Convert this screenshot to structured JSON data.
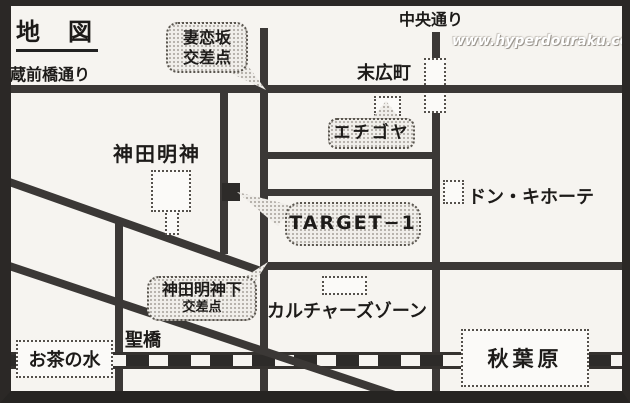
{
  "map": {
    "title": "地　図",
    "watermark": "www.hyperdouraku.com",
    "colors": {
      "paper": "#f6f4f0",
      "road": "#3b3836",
      "frame": "#2b2826",
      "rail_dark": "#2d2b29",
      "bubble_fill": "#f0eeea",
      "target_building": "#2d2b29"
    },
    "roads": {
      "kuramaebashi_dori": "蔵前橋通り",
      "chuo_dori": "中央通り"
    },
    "intersections": {
      "tsumakoizaka": {
        "line1": "妻恋坂",
        "line2": "交差点"
      },
      "kanda_myojin_shita": {
        "line1": "神田明神下",
        "line2": "交差点"
      }
    },
    "stations": {
      "suehirocho": "末広町",
      "ochanomizu": "お茶の水",
      "akihabara": "秋葉原"
    },
    "landmarks": {
      "kanda_myojin": "神田明神",
      "echigoya": "エチゴヤ",
      "target1": "TARGET−1",
      "don_quijote": "ドン・キホーテ",
      "cultures_zone": "カルチャーズゾーン",
      "hijiribashi": "聖橋"
    }
  }
}
